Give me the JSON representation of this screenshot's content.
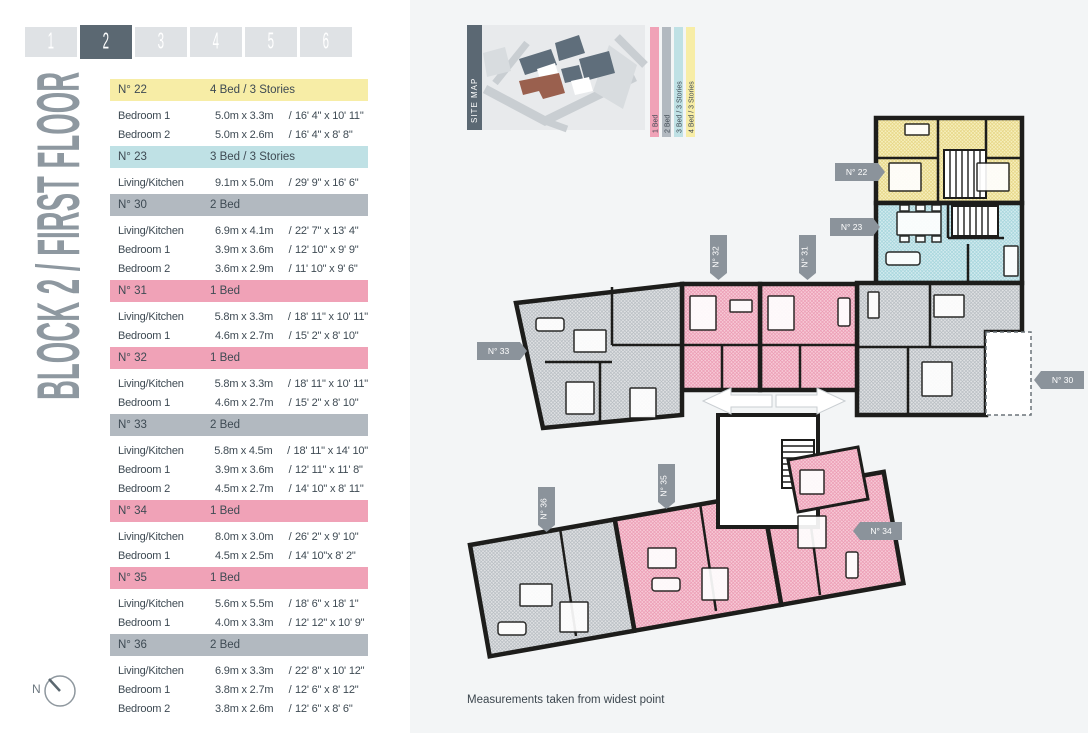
{
  "tabs": {
    "items": [
      "1",
      "2",
      "3",
      "4",
      "5",
      "6"
    ],
    "active_index": 1
  },
  "page_title": "BLOCK 2 / FIRST FLOOR",
  "site_map": {
    "label": "SITE MAP"
  },
  "legend": {
    "items": [
      {
        "label": "1 Bed",
        "category": "1bed"
      },
      {
        "label": "2 Bed",
        "category": "2bed"
      },
      {
        "label": "3 Bed / 3 Stories",
        "category": "3bed"
      },
      {
        "label": "4 Bed / 3 Stories",
        "category": "4bed"
      }
    ]
  },
  "dim_separator": "/",
  "units": [
    {
      "number": "N° 22",
      "type": "4 Bed / 3 Stories",
      "category": "4bed",
      "rooms": [
        {
          "name": "Bedroom 1",
          "metric": "5.0m x 3.3m",
          "imperial": "16' 4\" x 10' 11\""
        },
        {
          "name": "Bedroom 2",
          "metric": "5.0m x 2.6m",
          "imperial": "16' 4\" x 8' 8\""
        }
      ]
    },
    {
      "number": "N° 23",
      "type": "3 Bed / 3 Stories",
      "category": "3bed",
      "rooms": [
        {
          "name": "Living/Kitchen",
          "metric": "9.1m x 5.0m",
          "imperial": "29' 9\" x 16' 6\""
        }
      ]
    },
    {
      "number": "N° 30",
      "type": "2 Bed",
      "category": "2bed",
      "rooms": [
        {
          "name": "Living/Kitchen",
          "metric": "6.9m x 4.1m",
          "imperial": "22' 7\" x 13' 4\""
        },
        {
          "name": "Bedroom 1",
          "metric": "3.9m x 3.6m",
          "imperial": "12' 10\" x 9' 9\""
        },
        {
          "name": "Bedroom 2",
          "metric": "3.6m x 2.9m",
          "imperial": "11' 10\" x 9' 6\""
        }
      ]
    },
    {
      "number": "N° 31",
      "type": "1 Bed",
      "category": "1bed",
      "rooms": [
        {
          "name": "Living/Kitchen",
          "metric": "5.8m x 3.3m",
          "imperial": "18' 11\" x 10' 11\""
        },
        {
          "name": "Bedroom 1",
          "metric": "4.6m x 2.7m",
          "imperial": "15' 2\" x 8' 10\""
        }
      ]
    },
    {
      "number": "N° 32",
      "type": "1 Bed",
      "category": "1bed",
      "rooms": [
        {
          "name": "Living/Kitchen",
          "metric": "5.8m x 3.3m",
          "imperial": "18' 11\" x 10' 11\""
        },
        {
          "name": "Bedroom 1",
          "metric": "4.6m x 2.7m",
          "imperial": "15' 2\" x 8' 10\""
        }
      ]
    },
    {
      "number": "N° 33",
      "type": "2 Bed",
      "category": "2bed",
      "rooms": [
        {
          "name": "Living/Kitchen",
          "metric": "5.8m x 4.5m",
          "imperial": "18' 11\" x 14' 10\""
        },
        {
          "name": "Bedroom 1",
          "metric": "3.9m x 3.6m",
          "imperial": "12' 11\" x 11' 8\""
        },
        {
          "name": "Bedroom 2",
          "metric": "4.5m x 2.7m",
          "imperial": "14' 10\" x 8' 11\""
        }
      ]
    },
    {
      "number": "N° 34",
      "type": "1 Bed",
      "category": "1bed",
      "rooms": [
        {
          "name": "Living/Kitchen",
          "metric": "8.0m x 3.0m",
          "imperial": "26' 2\" x 9' 10\""
        },
        {
          "name": "Bedroom 1",
          "metric": "4.5m x 2.5m",
          "imperial": "14' 10\"x 8' 2\""
        }
      ]
    },
    {
      "number": "N° 35",
      "type": "1 Bed",
      "category": "1bed",
      "rooms": [
        {
          "name": "Living/Kitchen",
          "metric": "5.6m x 5.5m",
          "imperial": "18' 6\" x 18' 1\""
        },
        {
          "name": "Bedroom 1",
          "metric": "4.0m x 3.3m",
          "imperial": "12' 12\" x 10' 9\""
        }
      ]
    },
    {
      "number": "N° 36",
      "type": "2 Bed",
      "category": "2bed",
      "rooms": [
        {
          "name": "Living/Kitchen",
          "metric": "6.9m x 3.3m",
          "imperial": "22' 8\" x 10' 12\""
        },
        {
          "name": "Bedroom 1",
          "metric": "3.8m x 2.7m",
          "imperial": "12' 6\" x 8' 12\""
        },
        {
          "name": "Bedroom 2",
          "metric": "3.8m x 2.6m",
          "imperial": "12' 6\" x 8' 6\""
        }
      ]
    }
  ],
  "footnote": "Measurements taken from widest point",
  "compass": {
    "label": "N"
  },
  "colors": {
    "categories": {
      "1bed": {
        "header": "#f0a2b7",
        "fill": "#f7c9d6",
        "hatch": "#eb9bb3"
      },
      "2bed": {
        "header": "#b2b9c0",
        "fill": "#dfe1e3",
        "hatch": "#b7bdc2"
      },
      "3bed": {
        "header": "#bfe1e5",
        "fill": "#d2eaee",
        "hatch": "#a4d5dc"
      },
      "4bed": {
        "header": "#f7eda6",
        "fill": "#f6efbd",
        "hatch": "#e6d584"
      }
    },
    "tab_active": "#5b6872",
    "tab_inactive": "#dfe2e5",
    "tag_bg": "#8b939b",
    "wall": "#1d1d1b"
  }
}
